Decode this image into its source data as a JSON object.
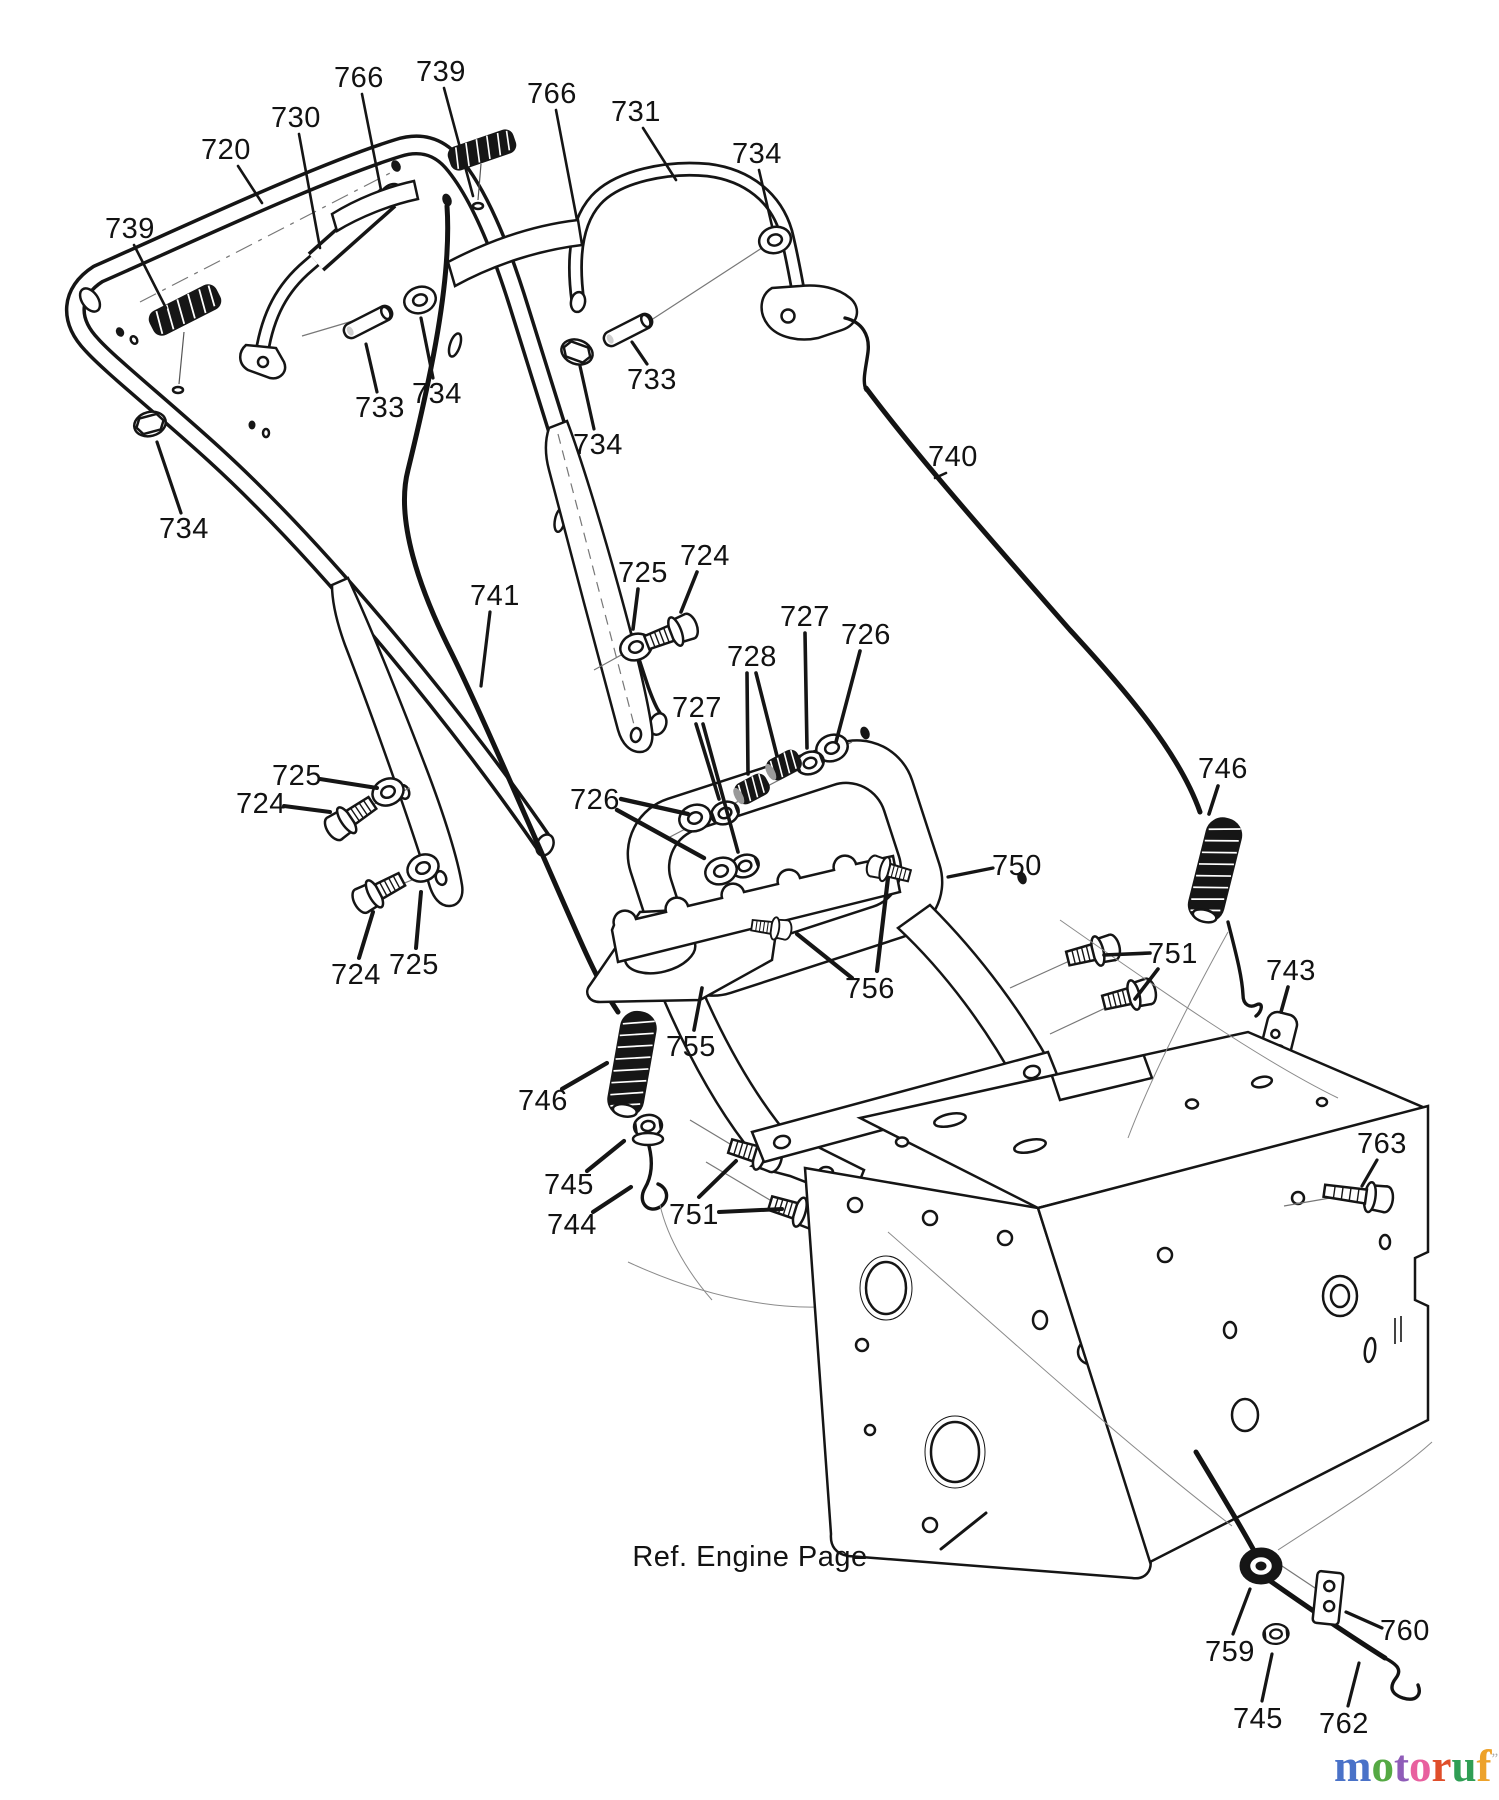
{
  "page": {
    "background": "#ffffff",
    "ink": "#151515",
    "title": "Handle Assembly parts diagram"
  },
  "footer_note": {
    "label": "Ref. Engine Page",
    "x": 750,
    "y": 1557,
    "anchor": "start",
    "leaders": [
      [
        941,
        1549,
        986,
        1513,
        3
      ]
    ]
  },
  "logo": {
    "suffix": ".de",
    "suffix_color": "#8d8d8d",
    "mark": "”",
    "mark_color": "#aaaaaa",
    "letters": [
      [
        "m",
        "#4a72c8"
      ],
      [
        "o",
        "#55a944"
      ],
      [
        "t",
        "#8f5cb8"
      ],
      [
        "o",
        "#e8609f"
      ],
      [
        "r",
        "#e04e2a"
      ],
      [
        "u",
        "#2f9e54"
      ],
      [
        "f",
        "#eda22a"
      ]
    ]
  },
  "callouts": [
    {
      "label": "720",
      "x": 226,
      "y": 150,
      "leaders": [
        [
          238,
          166,
          262,
          203,
          2.6
        ]
      ]
    },
    {
      "label": "730",
      "x": 296,
      "y": 118,
      "leaders": [
        [
          299,
          134,
          320,
          248,
          2.6
        ]
      ]
    },
    {
      "label": "766",
      "x": 359,
      "y": 78,
      "leaders": [
        [
          362,
          94,
          381,
          190,
          2.6
        ]
      ]
    },
    {
      "label": "739",
      "x": 441,
      "y": 72,
      "leaders": [
        [
          444,
          88,
          473,
          196,
          2.6
        ]
      ]
    },
    {
      "label": "766",
      "x": 552,
      "y": 94,
      "leaders": [
        [
          556,
          110,
          577,
          220,
          2.6
        ]
      ]
    },
    {
      "label": "731",
      "x": 636,
      "y": 112,
      "leaders": [
        [
          643,
          128,
          676,
          180,
          2.6
        ]
      ]
    },
    {
      "label": "734",
      "x": 757,
      "y": 154,
      "leaders": [
        [
          759,
          170,
          772,
          226,
          2.6
        ]
      ]
    },
    {
      "label": "739",
      "x": 130,
      "y": 229,
      "leaders": [
        [
          134,
          245,
          166,
          308,
          2.6
        ]
      ]
    },
    {
      "label": "733",
      "x": 380,
      "y": 408,
      "leaders": [
        [
          377,
          392,
          366,
          344,
          3.2
        ]
      ]
    },
    {
      "label": "734",
      "x": 437,
      "y": 394,
      "leaders": [
        [
          433,
          378,
          421,
          318,
          3.2
        ]
      ]
    },
    {
      "label": "734",
      "x": 598,
      "y": 445,
      "leaders": [
        [
          594,
          429,
          580,
          366,
          3.2
        ]
      ]
    },
    {
      "label": "733",
      "x": 652,
      "y": 380,
      "leaders": [
        [
          647,
          364,
          632,
          342,
          3.2
        ]
      ]
    },
    {
      "label": "734",
      "x": 184,
      "y": 529,
      "leaders": [
        [
          181,
          513,
          157,
          442,
          3.2
        ]
      ]
    },
    {
      "label": "740",
      "x": 953,
      "y": 457,
      "leaders": [
        [
          946,
          473,
          935,
          478,
          2.6
        ]
      ]
    },
    {
      "label": "741",
      "x": 495,
      "y": 596,
      "leaders": [
        [
          490,
          612,
          481,
          686,
          3.2
        ]
      ]
    },
    {
      "label": "725",
      "x": 643,
      "y": 573,
      "leaders": [
        [
          638,
          589,
          633,
          629,
          3.6
        ]
      ]
    },
    {
      "label": "724",
      "x": 705,
      "y": 556,
      "leaders": [
        [
          697,
          572,
          681,
          612,
          3.6
        ]
      ]
    },
    {
      "label": "727",
      "x": 805,
      "y": 617,
      "leaders": [
        [
          805,
          633,
          807,
          748,
          3.6
        ]
      ]
    },
    {
      "label": "726",
      "x": 866,
      "y": 635,
      "leaders": [
        [
          860,
          651,
          836,
          742,
          3.6
        ]
      ]
    },
    {
      "label": "728",
      "x": 752,
      "y": 657,
      "leaders": [
        [
          747,
          673,
          748,
          774,
          3.6
        ],
        [
          756,
          673,
          777,
          756,
          3.6
        ]
      ]
    },
    {
      "label": "727",
      "x": 697,
      "y": 708,
      "leaders": [
        [
          696,
          724,
          719,
          799,
          3.6
        ],
        [
          703,
          724,
          738,
          852,
          3.6
        ]
      ]
    },
    {
      "label": "726",
      "x": 595,
      "y": 800,
      "leaders": [
        [
          621,
          799,
          688,
          814,
          4.4
        ],
        [
          617,
          810,
          704,
          858,
          4.4
        ]
      ]
    },
    {
      "label": "725",
      "x": 297,
      "y": 776,
      "leaders": [
        [
          320,
          779,
          377,
          788,
          4
        ]
      ]
    },
    {
      "label": "724",
      "x": 261,
      "y": 804,
      "leaders": [
        [
          284,
          806,
          330,
          812,
          4
        ]
      ]
    },
    {
      "label": "724",
      "x": 356,
      "y": 975,
      "leaders": [
        [
          359,
          958,
          373,
          912,
          4
        ]
      ]
    },
    {
      "label": "725",
      "x": 414,
      "y": 965,
      "leaders": [
        [
          416,
          948,
          421,
          892,
          4
        ]
      ]
    },
    {
      "label": "750",
      "x": 1017,
      "y": 866,
      "leaders": [
        [
          993,
          868,
          948,
          877,
          3.2
        ]
      ]
    },
    {
      "label": "746",
      "x": 1223,
      "y": 769,
      "leaders": [
        [
          1218,
          786,
          1209,
          814,
          3.6
        ]
      ]
    },
    {
      "label": "751",
      "x": 1173,
      "y": 954,
      "leaders": [
        [
          1150,
          953,
          1104,
          955,
          3.6
        ],
        [
          1158,
          969,
          1135,
          999,
          3.6
        ]
      ]
    },
    {
      "label": "743",
      "x": 1291,
      "y": 971,
      "leaders": [
        [
          1288,
          987,
          1281,
          1012,
          3.6
        ]
      ]
    },
    {
      "label": "756",
      "x": 870,
      "y": 989,
      "leaders": [
        [
          877,
          971,
          888,
          878,
          4.2
        ],
        [
          852,
          978,
          797,
          934,
          4.2
        ]
      ]
    },
    {
      "label": "755",
      "x": 691,
      "y": 1047,
      "leaders": [
        [
          694,
          1030,
          702,
          988,
          3.6
        ]
      ]
    },
    {
      "label": "746",
      "x": 543,
      "y": 1101,
      "leaders": [
        [
          562,
          1089,
          607,
          1063,
          4.2
        ]
      ]
    },
    {
      "label": "745",
      "x": 569,
      "y": 1185,
      "leaders": [
        [
          587,
          1171,
          624,
          1141,
          4.2
        ]
      ]
    },
    {
      "label": "744",
      "x": 572,
      "y": 1225,
      "leaders": [
        [
          593,
          1212,
          631,
          1187,
          4.2
        ]
      ]
    },
    {
      "label": "751",
      "x": 694,
      "y": 1215,
      "leaders": [
        [
          699,
          1197,
          736,
          1161,
          4
        ],
        [
          719,
          1212,
          782,
          1209,
          4
        ]
      ]
    },
    {
      "label": "763",
      "x": 1382,
      "y": 1144,
      "leaders": [
        [
          1377,
          1160,
          1362,
          1186,
          3.2
        ]
      ]
    },
    {
      "label": "759",
      "x": 1230,
      "y": 1652,
      "leaders": [
        [
          1233,
          1634,
          1250,
          1589,
          3.2
        ]
      ]
    },
    {
      "label": "760",
      "x": 1405,
      "y": 1631,
      "leaders": [
        [
          1382,
          1628,
          1346,
          1612,
          3.2
        ]
      ]
    },
    {
      "label": "745",
      "x": 1258,
      "y": 1719,
      "leaders": [
        [
          1262,
          1701,
          1272,
          1654,
          3.2
        ]
      ]
    },
    {
      "label": "762",
      "x": 1344,
      "y": 1724,
      "leaders": [
        [
          1348,
          1706,
          1359,
          1663,
          3.2
        ]
      ]
    }
  ]
}
